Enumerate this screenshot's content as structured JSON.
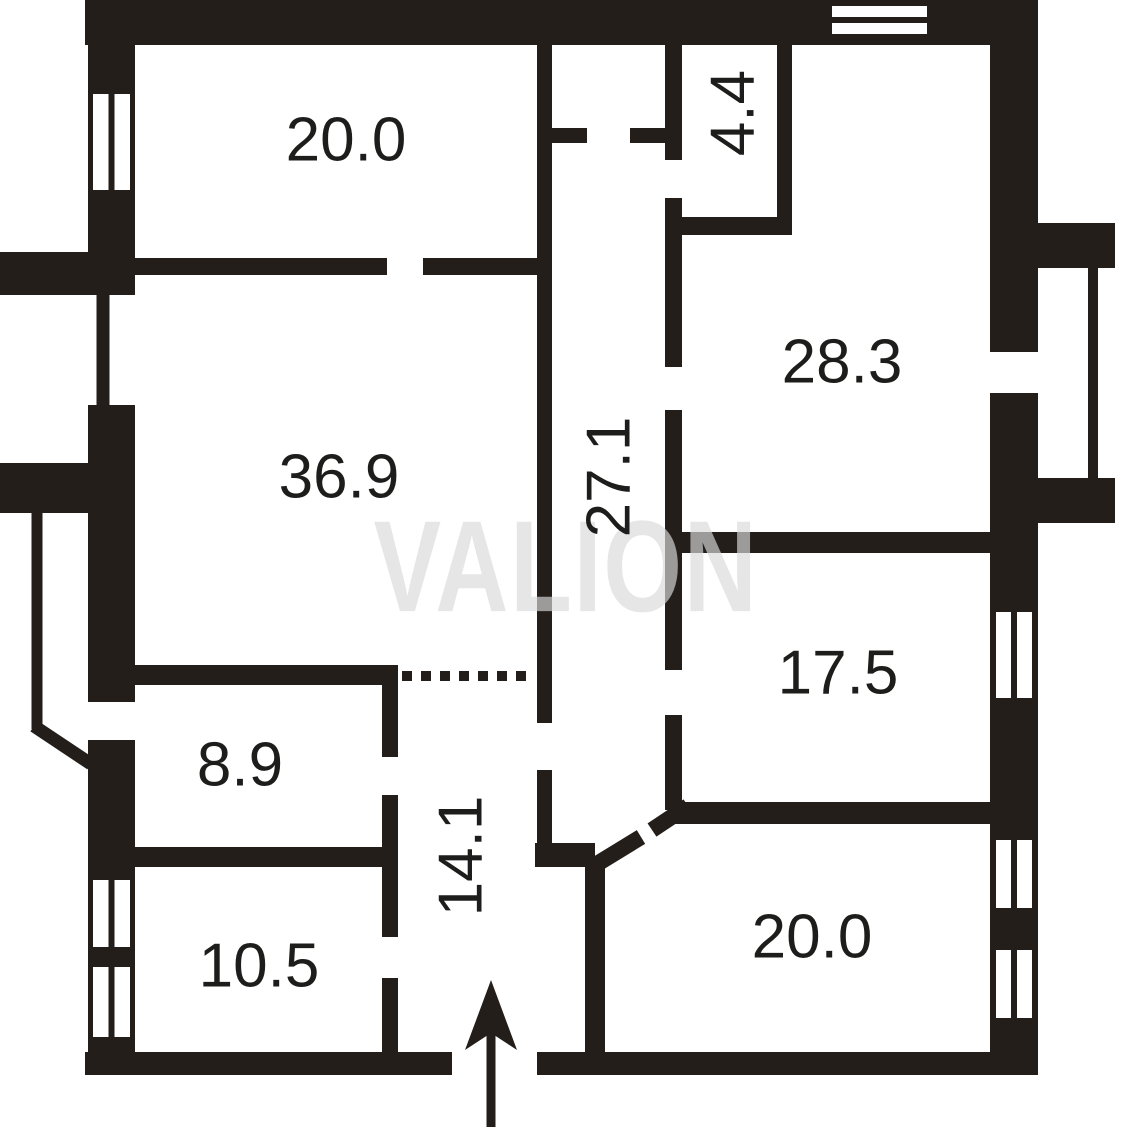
{
  "canvas": {
    "width": 1121,
    "height": 1127
  },
  "colors": {
    "wall": "#241e1a",
    "background": "#ffffff",
    "label": "#1d1d1b",
    "watermark": "#d9d9d9"
  },
  "watermark": {
    "text": "VALION",
    "x": 566,
    "y": 566,
    "font_size": 130,
    "scale_x": 0.78,
    "opacity": 0.67,
    "letter_spacing": 2
  },
  "rooms": [
    {
      "id": "room-top-left",
      "area_label": "20.0",
      "x": 346,
      "y": 140,
      "rotate": 0
    },
    {
      "id": "room-closet",
      "area_label": "4.4",
      "x": 733,
      "y": 113,
      "rotate": -90
    },
    {
      "id": "room-top-right",
      "area_label": "28.3",
      "x": 842,
      "y": 362,
      "rotate": 0
    },
    {
      "id": "room-main-left",
      "area_label": "36.9",
      "x": 339,
      "y": 477,
      "rotate": 0
    },
    {
      "id": "hall-central",
      "area_label": "27.1",
      "x": 609,
      "y": 477,
      "rotate": -90
    },
    {
      "id": "room-mid-right",
      "area_label": "17.5",
      "x": 838,
      "y": 673,
      "rotate": 0
    },
    {
      "id": "room-small-left",
      "area_label": "8.9",
      "x": 240,
      "y": 765,
      "rotate": 0
    },
    {
      "id": "corridor-entry",
      "area_label": "14.1",
      "x": 461,
      "y": 856,
      "rotate": -90
    },
    {
      "id": "room-bottom-left",
      "area_label": "10.5",
      "x": 259,
      "y": 966,
      "rotate": 0
    },
    {
      "id": "room-bottom-right",
      "area_label": "20.0",
      "x": 812,
      "y": 937,
      "rotate": 0
    }
  ],
  "plan": {
    "wall_rects": [
      {
        "name": "outer-wall-top",
        "x": 85,
        "y": 0,
        "w": 953,
        "h": 45
      },
      {
        "name": "outer-wall-left-upper",
        "x": 88,
        "y": 0,
        "w": 47,
        "h": 252
      },
      {
        "name": "left-pilaster-upper",
        "x": 0,
        "y": 252,
        "w": 135,
        "h": 43
      },
      {
        "name": "outer-wall-left-middle",
        "x": 88,
        "y": 405,
        "w": 47,
        "h": 297
      },
      {
        "name": "left-pilaster-lower",
        "x": 0,
        "y": 463,
        "w": 88,
        "h": 50
      },
      {
        "name": "outer-wall-left-lower",
        "x": 88,
        "y": 740,
        "w": 47,
        "h": 335
      },
      {
        "name": "outer-wall-bottom-left",
        "x": 85,
        "y": 1052,
        "w": 367,
        "h": 23
      },
      {
        "name": "outer-wall-bottom-right",
        "x": 537,
        "y": 1052,
        "w": 501,
        "h": 23
      },
      {
        "name": "outer-wall-right-upper",
        "x": 990,
        "y": 45,
        "w": 48,
        "h": 307
      },
      {
        "name": "outer-wall-right-lower",
        "x": 990,
        "y": 393,
        "w": 48,
        "h": 682
      },
      {
        "name": "balcony-wall-top",
        "x": 1038,
        "y": 223,
        "w": 77,
        "h": 45
      },
      {
        "name": "balcony-wall-bottom",
        "x": 1038,
        "y": 478,
        "w": 77,
        "h": 45
      },
      {
        "name": "wall-room20tl-bottom-west",
        "x": 135,
        "y": 258,
        "w": 252,
        "h": 17
      },
      {
        "name": "wall-room20tl-bottom-east",
        "x": 423,
        "y": 258,
        "w": 114,
        "h": 17
      },
      {
        "name": "wall-hall-west-upper",
        "x": 537,
        "y": 45,
        "w": 15,
        "h": 678
      },
      {
        "name": "wall-hall-west-lower",
        "x": 537,
        "y": 770,
        "w": 15,
        "h": 75
      },
      {
        "name": "wall-hall-southwest-stub",
        "x": 535,
        "y": 843,
        "w": 60,
        "h": 24
      },
      {
        "name": "wall-vestibule-stub-west",
        "x": 552,
        "y": 128,
        "w": 35,
        "h": 15
      },
      {
        "name": "wall-vestibule-stub-east",
        "x": 630,
        "y": 128,
        "w": 37,
        "h": 15
      },
      {
        "name": "wall-hall-east-a",
        "x": 665,
        "y": 45,
        "w": 17,
        "h": 115
      },
      {
        "name": "wall-hall-east-b",
        "x": 665,
        "y": 198,
        "w": 17,
        "h": 169
      },
      {
        "name": "wall-hall-east-c",
        "x": 665,
        "y": 410,
        "w": 17,
        "h": 260
      },
      {
        "name": "wall-hall-east-d",
        "x": 665,
        "y": 715,
        "w": 17,
        "h": 95
      },
      {
        "name": "wall-closet-south",
        "x": 665,
        "y": 217,
        "w": 127,
        "h": 18
      },
      {
        "name": "wall-closet-east",
        "x": 777,
        "y": 45,
        "w": 15,
        "h": 190
      },
      {
        "name": "wall-divider-283-175",
        "x": 682,
        "y": 532,
        "w": 308,
        "h": 21
      },
      {
        "name": "wall-175-south",
        "x": 670,
        "y": 802,
        "w": 320,
        "h": 22
      },
      {
        "name": "wall-369-south",
        "x": 135,
        "y": 665,
        "w": 262,
        "h": 20
      },
      {
        "name": "wall-corr14-west-a",
        "x": 382,
        "y": 665,
        "w": 16,
        "h": 92
      },
      {
        "name": "wall-corr14-west-b",
        "x": 382,
        "y": 795,
        "w": 16,
        "h": 142
      },
      {
        "name": "wall-corr14-west-c",
        "x": 382,
        "y": 978,
        "w": 16,
        "h": 74
      },
      {
        "name": "wall-divider-89-105",
        "x": 135,
        "y": 847,
        "w": 247,
        "h": 20
      },
      {
        "name": "wall-room20br-west",
        "x": 585,
        "y": 863,
        "w": 20,
        "h": 189
      }
    ],
    "thin_lines": [
      {
        "name": "left-recess-line-upper",
        "x1": 103,
        "y1": 295,
        "x2": 103,
        "y2": 410,
        "w": 13
      },
      {
        "name": "left-terrace-line",
        "x1": 37,
        "y1": 513,
        "x2": 37,
        "y2": 729,
        "w": 11
      },
      {
        "name": "left-terrace-diagonal",
        "x1": 34,
        "y1": 726,
        "x2": 91,
        "y2": 764,
        "w": 13
      },
      {
        "name": "balcony-edge-line",
        "x1": 1093,
        "y1": 240,
        "x2": 1093,
        "y2": 500,
        "w": 10
      }
    ],
    "diagonal_walls": [
      {
        "name": "door-chamfer-leaf",
        "x1": 592,
        "y1": 867,
        "x2": 641,
        "y2": 837,
        "w": 16
      },
      {
        "name": "door-chamfer-jamb",
        "x1": 652,
        "y1": 830,
        "x2": 688,
        "y2": 806,
        "w": 16
      }
    ],
    "dotted_line": {
      "name": "open-boundary-dotted",
      "x1": 402,
      "y1": 676,
      "x2": 535,
      "y2": 676,
      "w": 10,
      "dash": "10 9"
    },
    "windows": [
      {
        "name": "window-left-top",
        "orient": "v",
        "x": 93,
        "y": 94,
        "w": 37,
        "h": 96
      },
      {
        "name": "window-left-mid",
        "orient": "v",
        "x": 93,
        "y": 880,
        "w": 37,
        "h": 67
      },
      {
        "name": "window-left-bottom",
        "orient": "v",
        "x": 93,
        "y": 967,
        "w": 37,
        "h": 70
      },
      {
        "name": "window-top",
        "orient": "h",
        "x": 832,
        "y": 6,
        "w": 95,
        "h": 28
      },
      {
        "name": "window-right-175",
        "orient": "v",
        "x": 996,
        "y": 612,
        "w": 36,
        "h": 86
      },
      {
        "name": "window-right-20a",
        "orient": "v",
        "x": 996,
        "y": 840,
        "w": 36,
        "h": 68
      },
      {
        "name": "window-right-20b",
        "orient": "v",
        "x": 996,
        "y": 950,
        "w": 36,
        "h": 68
      }
    ],
    "entrance_arrow": {
      "shaft": {
        "x": 491,
        "y1": 1008,
        "y2": 1127,
        "w": 9
      },
      "head_points": "491,980 517,1050 491,1033 465,1050"
    }
  }
}
